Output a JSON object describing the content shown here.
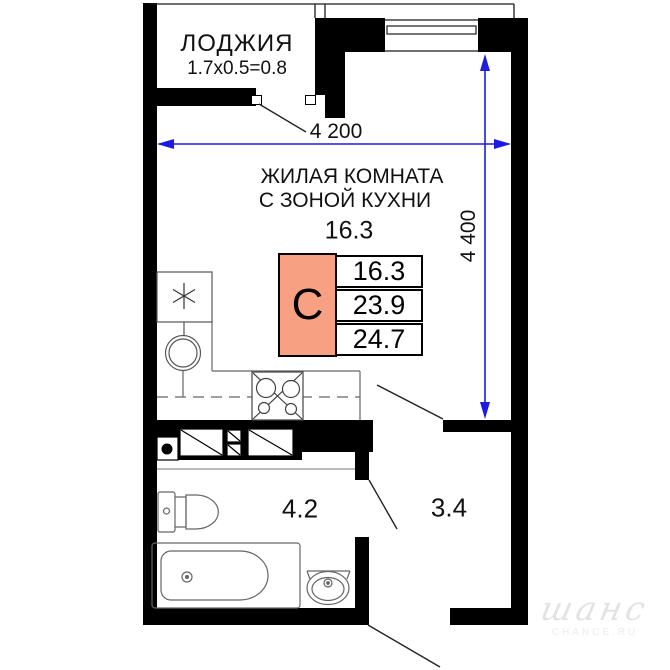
{
  "plan_title": "Studio apartment floor plan",
  "loggia": {
    "label": "ЛОДЖИЯ",
    "dims": "1.7x0.5=0.8"
  },
  "room": {
    "label_line1": "ЖИЛАЯ КОМНАТА",
    "label_line2": "С ЗОНОЙ КУХНИ",
    "area_big": "16.3"
  },
  "spec": {
    "type_letter": "С",
    "area_living": "16.3",
    "area_main": "23.9",
    "area_total": "24.7",
    "fill_color": "#F7A082"
  },
  "dimensions": {
    "width": "4 200",
    "height": "4 400",
    "line_color": "#1C1CDF"
  },
  "areas": {
    "bathroom": "4.2",
    "hall": "3.4"
  },
  "watermark": {
    "logo_text": "шанс",
    "caption": "CHANCE.RU"
  },
  "icons": {
    "fridge": "asterisk-icon",
    "kitchen_sink": "double-circle-icon",
    "stove": "four-burner-icon",
    "toilet": "toilet-icon",
    "bathtub": "bathtub-icon",
    "washbasin": "basin-icon",
    "vent_shaft": "hatched-box-icon",
    "riser": "black-dot-icon"
  }
}
